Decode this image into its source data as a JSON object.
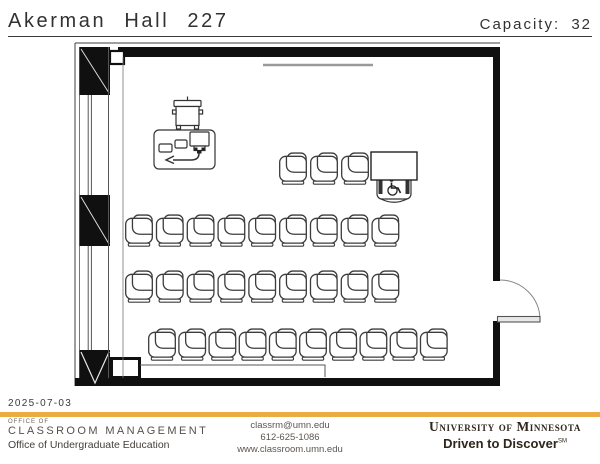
{
  "header": {
    "room_title": "Akerman Hall 227",
    "capacity_label": "Capacity:",
    "capacity_value": "32"
  },
  "date": "2025-07-03",
  "footer": {
    "left": {
      "line1": "OFFICE OF",
      "line2": "CLASSROOM MANAGEMENT",
      "line3": "Office of Undergraduate Education"
    },
    "center": {
      "email": "classrm@umn.edu",
      "phone": "612-625-1086",
      "website": "www.classroom.umn.edu"
    },
    "right": {
      "university": "University of Minnesota",
      "tagline": "Driven to Discover",
      "tagline_mark": "SM"
    }
  },
  "brand": {
    "gold_bar_color": "#EBAD43",
    "ink_color": "#2F261C"
  },
  "floorplan": {
    "chair_icon": "tablet-arm-chair-icon",
    "accessible_icon": "wheelchair-icon",
    "chair_w": 30,
    "chair_h": 35,
    "seat_rows": [
      {
        "y": 151,
        "x": 278,
        "count": 3,
        "dx": 31
      },
      {
        "y": 213,
        "x": 124,
        "count": 9,
        "dx": 30.8
      },
      {
        "y": 269,
        "x": 124,
        "count": 9,
        "dx": 30.8
      },
      {
        "y": 327,
        "x": 147,
        "count": 10,
        "dx": 30.2
      }
    ],
    "accessible_seats": 1,
    "total_capacity": 32
  }
}
